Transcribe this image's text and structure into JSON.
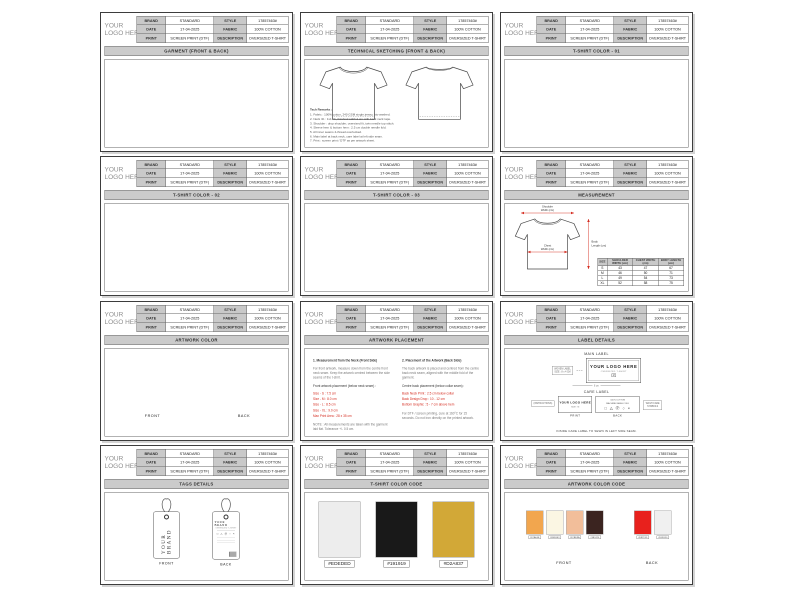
{
  "header": {
    "logo_line1": "YOUR",
    "logo_line2": "LOGO HERE",
    "rows": [
      {
        "label1": "BRAND",
        "value1": "STANDARD",
        "label2": "STYLE",
        "value2": "17857463#"
      },
      {
        "label1": "DATE",
        "value1": "17-04-2025",
        "label2": "FABRIC",
        "value2": "100% COTTON"
      },
      {
        "label1": "PRINT",
        "value1": "SCREEN PRINT (DTF)",
        "label2": "DESCRIPTION",
        "value2": "OVERSIZED T-SHIRT"
      }
    ]
  },
  "pages": {
    "garment": {
      "title": "GARMENT (FRONT & BACK)"
    },
    "technical": {
      "title": "TECHNICAL SKETCHING (FRONT & BACK)",
      "notes_title": "Tech Remarks :",
      "notes": [
        "1. Fabric : 100% cotton, 240 GSM single jersey, bio-washed.",
        "2. Neck rib : 1x1 rib, finished width 2 cm with back neck tape.",
        "3. Shoulder : drop shoulder, oversized fit, twin needle top stitch.",
        "4. Sleeve hem & bottom hem : 2.5 cm double needle fold.",
        "5. All inner seams 4-thread overlocked.",
        "6. Main label at back neck, care label at left side seam.",
        "7. Print : screen print / DTF as per artwork sheet."
      ]
    },
    "color01": {
      "title": "T-SHIRT COLOR - 01"
    },
    "color02": {
      "title": "T-SHIRT COLOR - 02"
    },
    "color03": {
      "title": "T-SHIRT COLOR - 03"
    },
    "measurement": {
      "title": "MEASUREMENT",
      "labels": {
        "shoulder_1": "Shoulder",
        "shoulder_2": "Width (cm)",
        "chest_1": "Chest",
        "chest_2": "Width (cm)",
        "length_1": "Body",
        "length_2": "Length (cm)"
      },
      "table": {
        "headers": [
          "SIZE",
          "SHOULDER WIDTH (cm)",
          "CHEST WIDTH (cm)",
          "BODY LENGTH (cm)"
        ],
        "rows": [
          {
            "size": "S",
            "shoulder": "43",
            "chest": "47",
            "length": "67"
          },
          {
            "size": "M",
            "shoulder": "46",
            "chest": "50",
            "length": "71"
          },
          {
            "size": "L",
            "shoulder": "49",
            "chest": "54",
            "length": "73"
          },
          {
            "size": "XL",
            "shoulder": "52",
            "chest": "58",
            "length": "75"
          }
        ]
      }
    },
    "artwork_color": {
      "title": "ARTWORK COLOR",
      "front_caption": "FRONT",
      "back_caption": "BACK"
    },
    "artwork_placement": {
      "title": "ARTWORK PLACEMENT",
      "left": {
        "heading": "1. Measurement from the Neck (Front Side)",
        "para": "For front artwork, measure down from the centre front neck seam. Keep the artwork centred between the side seams of the t-shirt.",
        "sub": "Front artwork placement (below neck seam) :",
        "red_lines": [
          "Size - S : 7.5 cm",
          "Size - M : 8.0 cm",
          "Size - L : 8.5 cm",
          "Size - XL : 9.0 cm",
          "Max Print Area : 28 x 35 cm"
        ],
        "note": "NOTE : All measurements are taken with the garment laid flat. Tolerance +/- 0.5 cm."
      },
      "right": {
        "heading": "2. Placement of the Artwork (Back Side)",
        "para": "The back artwork is placed and centred from the centre back neck seam, aligned with the middle fold of the garment.",
        "sub": "Centre back placement (below collar seam) :",
        "red_lines": [
          "Back Neck Print : 2.5 cm below collar",
          "Back Design Drop : 10 - 12 cm",
          "Bottom Graphic : 5 - 7 cm above hem"
        ],
        "note": "For DTF / screen printing, cure at 160°C for 15 seconds. Do not iron directly on the printed artwork."
      }
    },
    "label_details": {
      "title": "LABEL DETAILS",
      "main_heading": "MAIN LABEL",
      "main_annotation_1": "WOVEN LABEL",
      "main_annotation_2": "SIZE : 8 x 4 CM",
      "main_brand": "YOUR LOGO HERE",
      "main_sub": "OVERSIZED T-SHIRT",
      "main_size": "M",
      "main_width": "8 cm",
      "care_heading": "CARE LABEL",
      "care_annotation_left": "(INSTRUCTIONS)",
      "care_print_brand": "YOUR LOGO HERE",
      "care_print_size": "SIZE : M",
      "print_caption": "PRINT",
      "care_back_1": "100% COTTON",
      "care_back_2": "MACHINE WASH COLD",
      "care_symbols": "□ △ Ⓟ ○ ×",
      "back_caption": "BACK",
      "care_annotation_right_1": "WASH CARE",
      "care_annotation_right_2": "SYMBOLS",
      "footnote": "INSIDE CARE LABEL TO SEWN IN LEFT SIDE SEAM."
    },
    "tags_details": {
      "title": "TAGS DETAILS",
      "front_tag_text": "YOUR BRAND",
      "back_tag_brand": "YOUR BRAND",
      "back_tag_sub": "OVERSIZED T-SHIRT",
      "back_tag_symbols": "□ △ Ⓟ ○ ×",
      "front_caption": "FRONT",
      "back_caption": "BACK"
    },
    "tshirt_color_code": {
      "title": "T-SHIRT COLOR CODE",
      "swatches": [
        {
          "hex": "#EDEDED",
          "label": "#EDEDED"
        },
        {
          "hex": "#191919",
          "label": "#191919"
        },
        {
          "hex": "#D2A837",
          "label": "#D2A837"
        }
      ]
    },
    "artwork_color_code": {
      "title": "ARTWORK COLOR CODE",
      "front_caption": "FRONT",
      "back_caption": "BACK",
      "front_swatches": [
        {
          "hex": "#F2A64E",
          "label": "#F2A64E"
        },
        {
          "hex": "#FBF6E3",
          "label": "#FBF6E3"
        },
        {
          "hex": "#F2BE9A",
          "label": "#F2BE9A"
        },
        {
          "hex": "#3B2420",
          "label": "#3B2420"
        }
      ],
      "back_swatches": [
        {
          "hex": "#E8211D",
          "label": "#E8211D"
        },
        {
          "hex": "#F0F0F0",
          "label": "#F0F0F0"
        }
      ]
    }
  },
  "accents": {
    "red": "#D42A1E",
    "grey_fill": "#C9C9C9"
  }
}
